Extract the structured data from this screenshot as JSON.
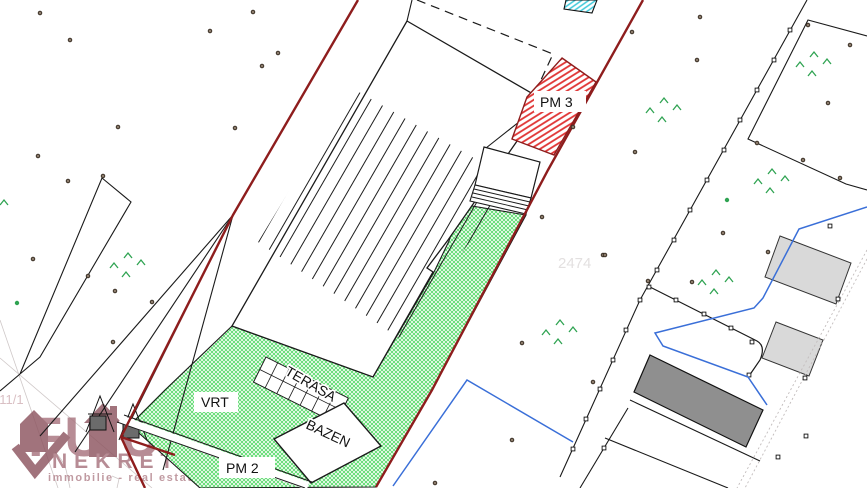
{
  "plan": {
    "labels": {
      "pm3": "PM 3",
      "pm2": "PM 2",
      "vrt": "VRT",
      "bazen": "BAZEN",
      "terasa": "TERASA",
      "parcel_number_right": "2474",
      "parcel_number_left": "411/1"
    },
    "watermark": {
      "brand_part1": "FU",
      "brand_part2": "URA",
      "brand_bottom": "NEKRETNINE",
      "tagline": "immobilie - real estate - nekretnine"
    },
    "colors": {
      "boundary_red": "#8e1d1d",
      "hatch_red": "#e03333",
      "hatch_green": "#3fd455",
      "hatch_cyan": "#3cc8da",
      "building_dark_gray": "#8f8f8f",
      "building_light_gray": "#d9d9d9",
      "pipe_blue": "#3a6fd8",
      "watermark_mauve": "#a8747e"
    }
  }
}
